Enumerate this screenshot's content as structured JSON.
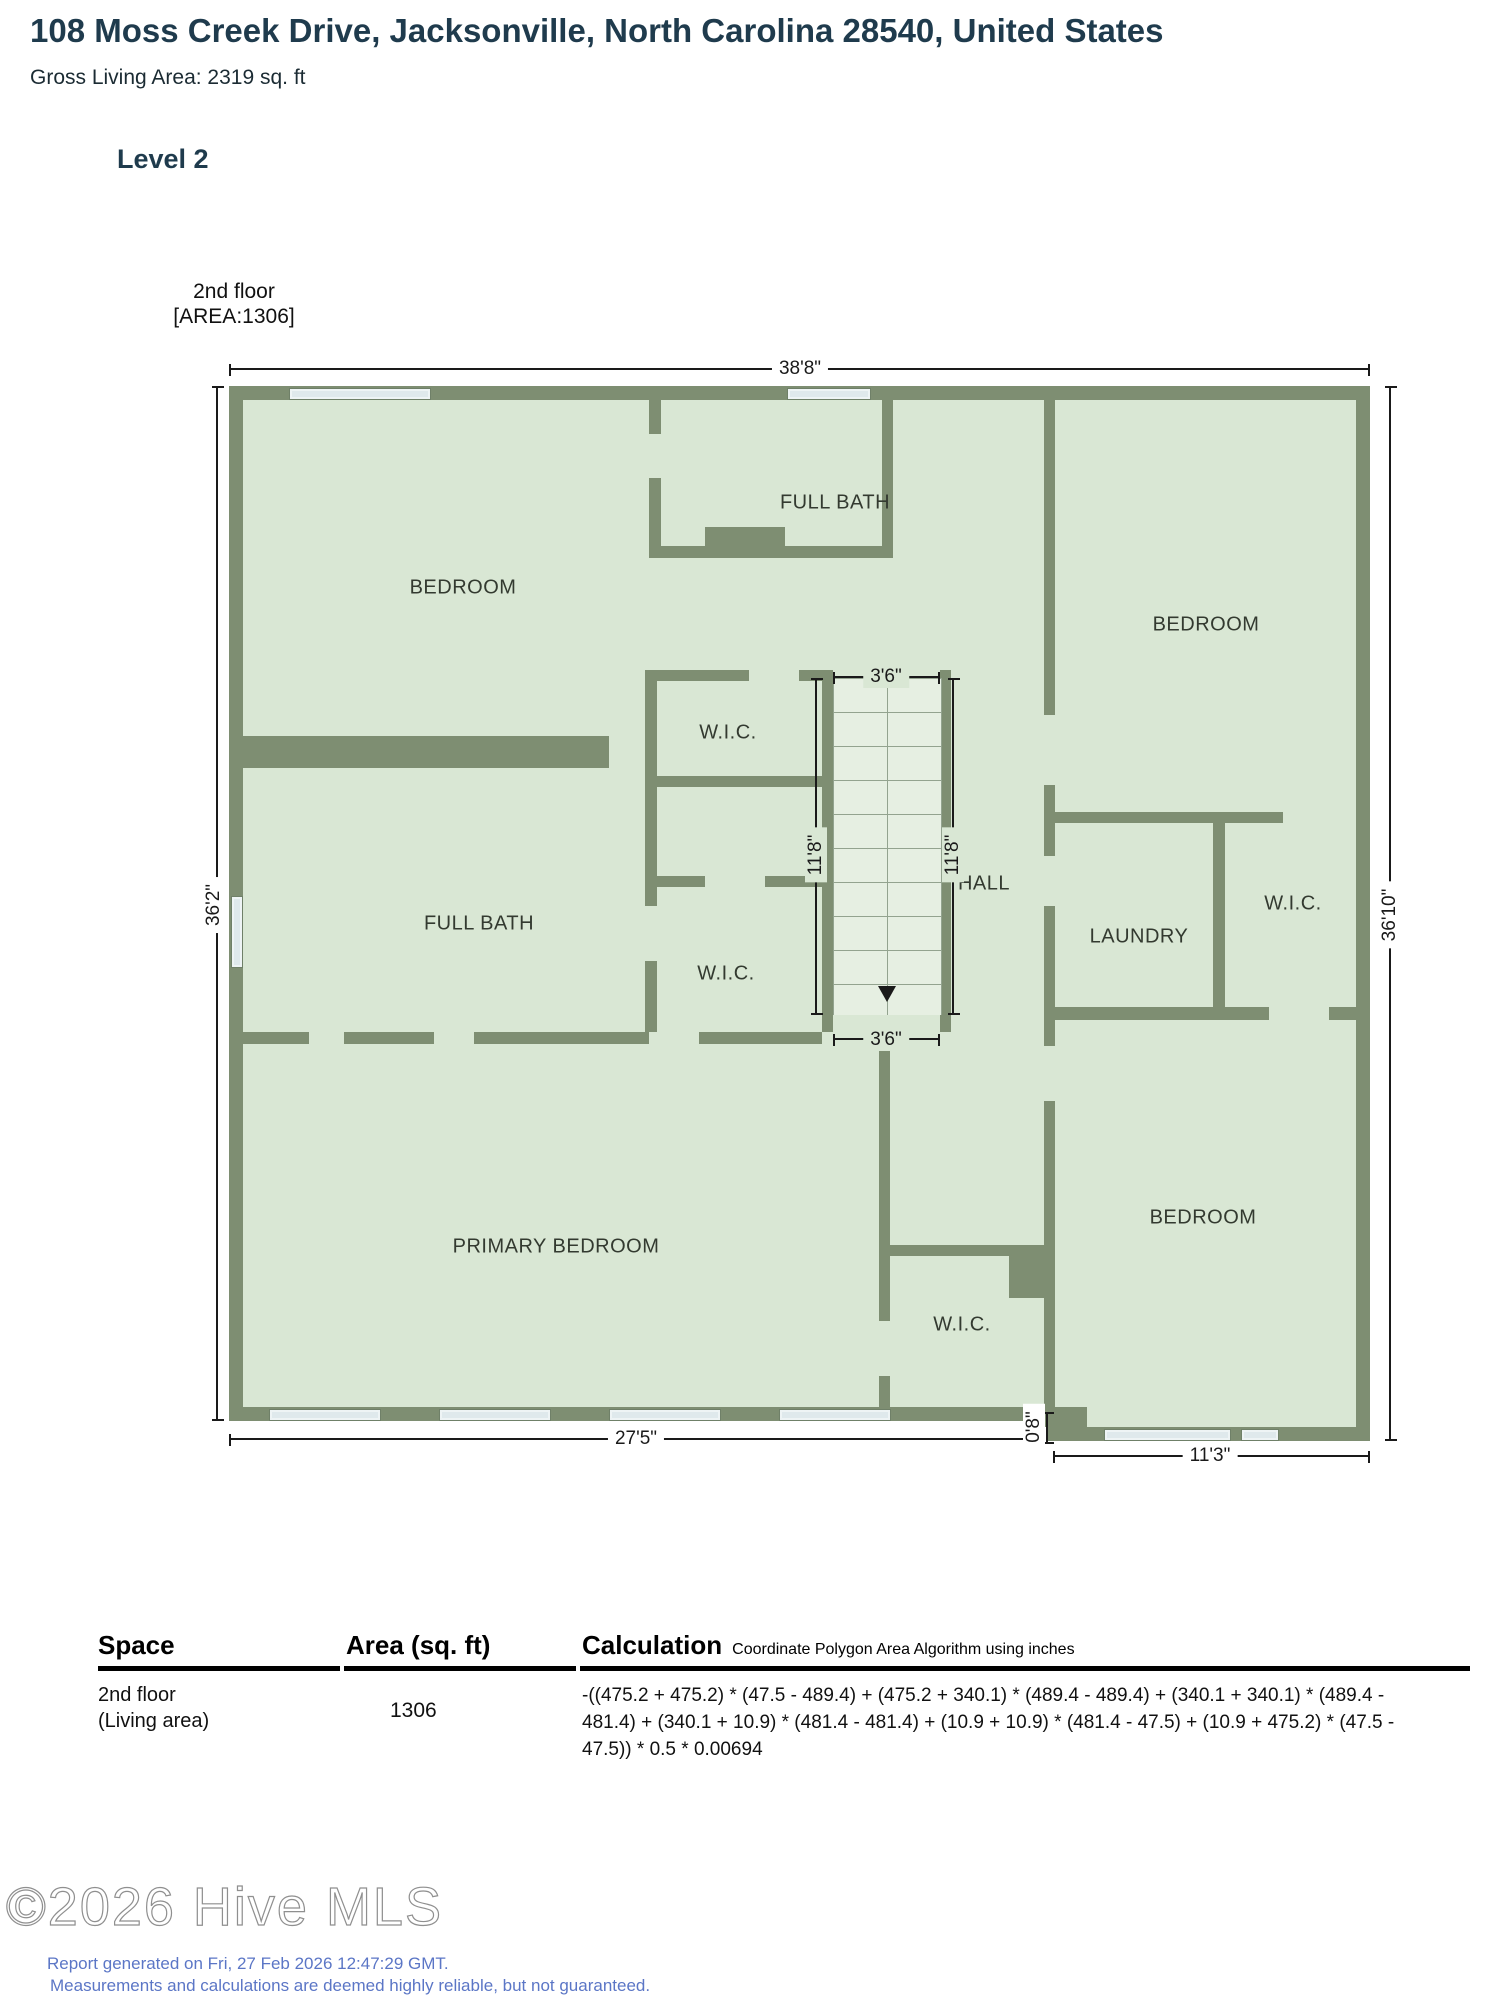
{
  "header": {
    "title": "108 Moss Creek Drive, Jacksonville, North Carolina 28540, United States",
    "gross_living_area": "Gross Living Area: 2319 sq. ft",
    "level": "Level 2"
  },
  "floor_tag": {
    "line1": "2nd floor",
    "line2": "[AREA:1306]"
  },
  "plan": {
    "rooms": [
      {
        "id": "bedroom-top-left",
        "label": "BEDROOM"
      },
      {
        "id": "full-bath-top",
        "label": "FULL BATH"
      },
      {
        "id": "bedroom-top-right",
        "label": "BEDROOM"
      },
      {
        "id": "wic-upper",
        "label": "W.I.C."
      },
      {
        "id": "hall",
        "label": "HALL"
      },
      {
        "id": "full-bath-left",
        "label": "FULL BATH"
      },
      {
        "id": "wic-middle",
        "label": "W.I.C."
      },
      {
        "id": "laundry",
        "label": "LAUNDRY"
      },
      {
        "id": "wic-right",
        "label": "W.I.C."
      },
      {
        "id": "primary-bedroom",
        "label": "PRIMARY BEDROOM"
      },
      {
        "id": "wic-bottom",
        "label": "W.I.C."
      },
      {
        "id": "bedroom-bottom-right",
        "label": "BEDROOM"
      }
    ],
    "dimensions": {
      "top_width": "38'8\"",
      "left_height": "36'2\"",
      "right_height": "36'10\"",
      "bottom_left_width": "27'5\"",
      "bottom_right_width": "11'3\"",
      "bottom_offset": "0'8\"",
      "stair_width_top": "3'6\"",
      "stair_width_bottom": "3'6\"",
      "stair_left_height": "11'8\"",
      "stair_right_height": "11'8\""
    }
  },
  "table": {
    "headers": {
      "space": "Space",
      "area": "Area (sq. ft)",
      "calculation": "Calculation",
      "calculation_note": "Coordinate Polygon Area Algorithm using inches"
    },
    "row": {
      "space_line1": "2nd floor",
      "space_line2": "(Living area)",
      "area": "1306",
      "calculation": "-((475.2 + 475.2) * (47.5 - 489.4) + (475.2 + 340.1) * (489.4 - 489.4) + (340.1 + 340.1) * (489.4 -\n481.4) + (340.1 + 10.9) * (481.4 - 481.4) + (10.9 + 10.9) * (481.4 - 47.5) + (10.9 + 475.2) * (47.5 -\n47.5)) * 0.5 * 0.00694"
    }
  },
  "footer": {
    "watermark": "©2026 Hive MLS",
    "generated": "Report generated on Fri, 27 Feb 2026 12:47:29 GMT.",
    "disclaimer": "Measurements and calculations are deemed highly reliable, but not guaranteed."
  },
  "colors": {
    "wall": "#7e8e72",
    "floor": "#d9e7d4",
    "window": "#dfe9ec",
    "title_text": "#1f3b4d",
    "footer_text": "#5b76c6"
  }
}
